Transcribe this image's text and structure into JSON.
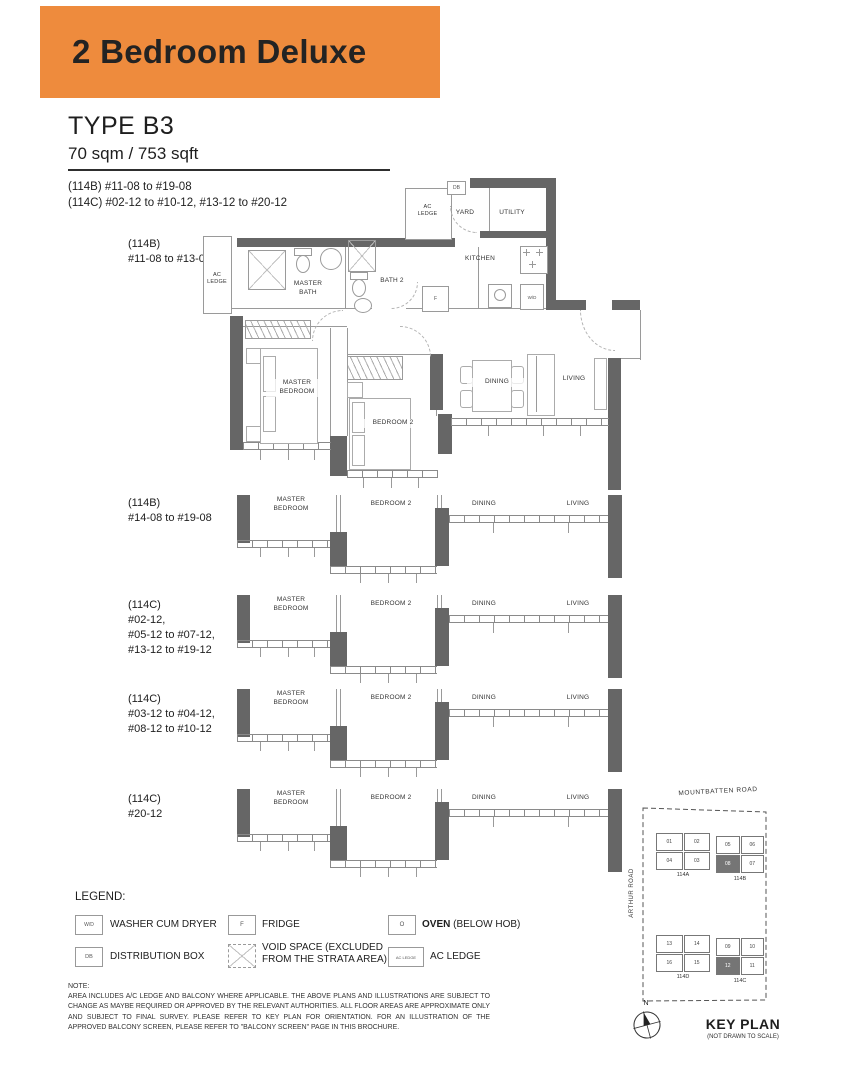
{
  "colors": {
    "banner_bg": "#ee8b3d",
    "wall": "#666666"
  },
  "banner": {
    "title": "2 Bedroom Deluxe"
  },
  "header": {
    "type_label": "TYPE B3",
    "area": "70 sqm / 753 sqft",
    "units_114b": "(114B) #11-08 to #19-08",
    "units_114c": "(114C) #02-12 to #10-12, #13-12 to #20-12"
  },
  "main_plan": {
    "stack_label": "(114B)\n#11-08 to #13-08",
    "rooms": {
      "ac_ledge_left": "AC\nLEDGE",
      "ac_ledge_top": "AC\nLEDGE",
      "yard": "YARD",
      "utility": "UTILITY",
      "kitchen": "KITCHEN",
      "master_bath": "MASTER\nBATH",
      "bath2": "BATH 2",
      "master_bedroom": "MASTER\nBEDROOM",
      "bedroom2": "BEDROOM 2",
      "dining": "DINING",
      "living": "LIVING"
    },
    "tags": {
      "db": "DB",
      "f": "F",
      "wd": "W/D"
    }
  },
  "variants": [
    {
      "stack_label": "(114B)\n#14-08 to #19-08",
      "rooms": {
        "master_bedroom": "MASTER\nBEDROOM",
        "bedroom2": "BEDROOM 2",
        "dining": "DINING",
        "living": "LIVING"
      }
    },
    {
      "stack_label": "(114C)\n#02-12,\n#05-12 to #07-12,\n#13-12 to #19-12",
      "rooms": {
        "master_bedroom": "MASTER\nBEDROOM",
        "bedroom2": "BEDROOM 2",
        "dining": "DINING",
        "living": "LIVING"
      }
    },
    {
      "stack_label": "(114C)\n#03-12 to #04-12,\n#08-12 to #10-12",
      "rooms": {
        "master_bedroom": "MASTER\nBEDROOM",
        "bedroom2": "BEDROOM 2",
        "dining": "DINING",
        "living": "LIVING"
      }
    },
    {
      "stack_label": "(114C)\n#20-12",
      "rooms": {
        "master_bedroom": "MASTER\nBEDROOM",
        "bedroom2": "BEDROOM 2",
        "dining": "DINING",
        "living": "LIVING"
      }
    }
  ],
  "legend": {
    "title": "LEGEND:",
    "wd": {
      "symbol": "W/D",
      "label": "WASHER CUM DRYER"
    },
    "fridge": {
      "symbol": "F",
      "label": "FRIDGE"
    },
    "oven": {
      "symbol": "O",
      "label_bold": "OVEN",
      "label_rest": " (BELOW HOB)"
    },
    "db": {
      "symbol": "DB",
      "label": "DISTRIBUTION BOX"
    },
    "void": {
      "label": "VOID SPACE (EXCLUDED\nFROM THE STRATA AREA)"
    },
    "ac_ledge": {
      "symbol": "AC LEDGE",
      "label": "AC LEDGE"
    }
  },
  "note": {
    "title": "NOTE:",
    "body": "AREA INCLUDES A/C LEDGE AND BALCONY WHERE APPLICABLE. THE ABOVE PLANS AND ILLUSTRATIONS ARE SUBJECT TO CHANGE AS MAYBE REQUIRED OR APPROVED BY THE RELEVANT AUTHORITIES. ALL FLOOR AREAS ARE APPROXIMATE ONLY AND SUBJECT TO FINAL SURVEY. PLEASE REFER TO KEY PLAN FOR ORIENTATION. FOR AN ILLUSTRATION OF THE APPROVED BALCONY SCREEN, PLEASE REFER TO \"BALCONY SCREEN\" PAGE IN THIS BROCHURE."
  },
  "keyplan": {
    "road_top": "MOUNTBATTEN ROAD",
    "road_left": "ARTHUR ROAD",
    "clusters": [
      {
        "name": "114A",
        "units": [
          [
            "01",
            "02"
          ],
          [
            "04",
            "03"
          ]
        ]
      },
      {
        "name": "114B",
        "units": [
          [
            "05",
            "06"
          ],
          [
            "08",
            "07"
          ]
        ]
      },
      {
        "name": "114D",
        "units": [
          [
            "13",
            "14"
          ],
          [
            "16",
            "15"
          ]
        ]
      },
      {
        "name": "114C",
        "units": [
          [
            "09",
            "10"
          ],
          [
            "12",
            "11"
          ]
        ]
      }
    ],
    "compass_n": "N",
    "title": "KEY PLAN",
    "subtitle": "(NOT DRAWN TO SCALE)"
  }
}
